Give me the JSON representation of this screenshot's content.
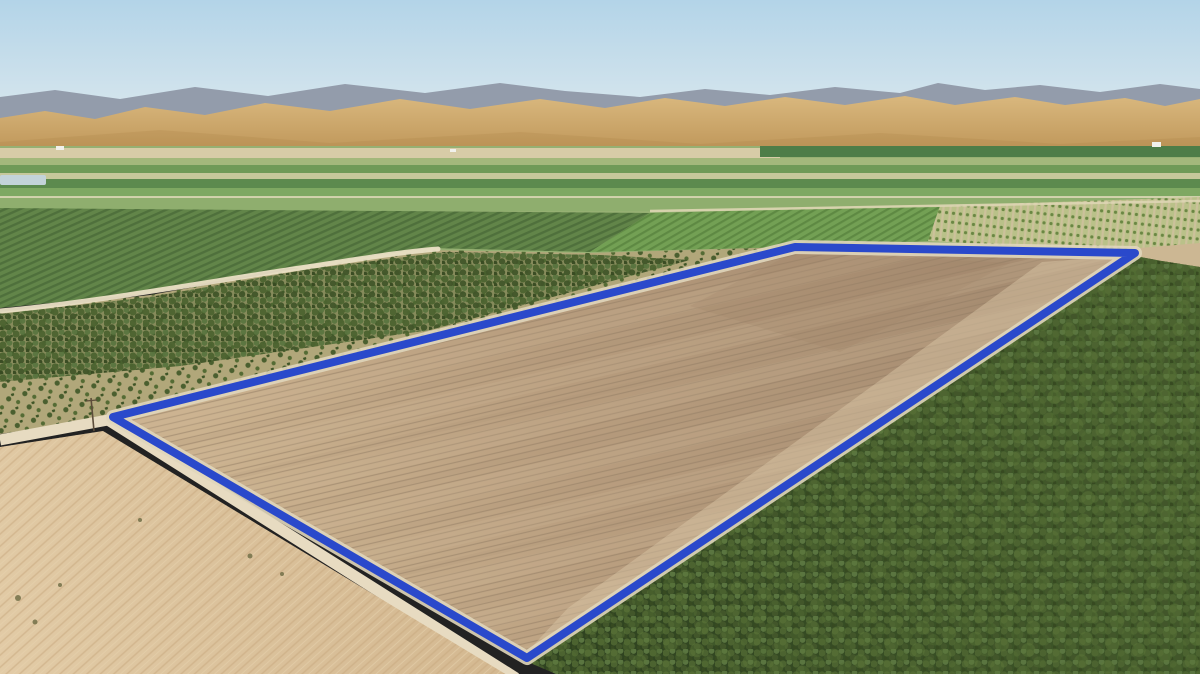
{
  "meta": {
    "title": "Aerial farmland parcel photo",
    "width": 1200,
    "height": 674,
    "description": "Drone aerial photograph of a large tilled dirt parcel outlined with a thick blue boundary, bordered by a dirt road and irrigation canal, surrounded by orchards, a vineyard block, striped green valley fields, a sandy fallow field, golden rolling hills and a hazy blue sky with a distant gray mountain ridge"
  },
  "palette": {
    "boundary_blue": "#2a49cb",
    "berm_light": "#e0d6bb",
    "sky_top": "#b3d4e8",
    "sky_horizon": "#e4edf1",
    "mountain_gray": "#939cab",
    "hill_gold_light": "#d9b87e",
    "hill_gold_dark": "#ba9052",
    "parcel_dirt_dark": "#a78d72",
    "parcel_dirt_light": "#cbb28f",
    "orchard_dark_green": "#35482a",
    "sand_light": "#e2cba6",
    "road_tan": "#e7dbc1",
    "canal_dark": "#5c6a4a",
    "water_gray": "#adbac1"
  },
  "scene": {
    "gradients": [
      {
        "id": "skyGrad",
        "x1": 0,
        "y1": 0,
        "x2": 0,
        "y2": 162,
        "stops": [
          [
            "0%",
            "#b3d4e8"
          ],
          [
            "55%",
            "#cfe2ec"
          ],
          [
            "100%",
            "#e4edf1"
          ]
        ]
      },
      {
        "id": "hillGrad",
        "x1": 0,
        "y1": 96,
        "x2": 0,
        "y2": 162,
        "stops": [
          [
            "0%",
            "#d9b87e"
          ],
          [
            "100%",
            "#ba9052"
          ]
        ]
      },
      {
        "id": "parcelGrad",
        "x1": 980,
        "y1": 280,
        "x2": 260,
        "y2": 580,
        "stops": [
          [
            "0%",
            "#a78d72"
          ],
          [
            "55%",
            "#b89d7e"
          ],
          [
            "100%",
            "#cbb28f"
          ]
        ]
      },
      {
        "id": "sandGrad",
        "x1": 520,
        "y1": 500,
        "x2": 0,
        "y2": 678,
        "stops": [
          [
            "0%",
            "#d2b68e"
          ],
          [
            "100%",
            "#e2cba6"
          ]
        ]
      },
      {
        "id": "orchardGrad",
        "x1": 1150,
        "y1": 300,
        "x2": 620,
        "y2": 660,
        "stops": [
          [
            "0%",
            "#46602c"
          ],
          [
            "100%",
            "#2f4320"
          ]
        ]
      }
    ],
    "patterns": [
      {
        "id": "furrows",
        "w": 6,
        "h": 6,
        "rotate": -13,
        "shapes": [
          {
            "t": "line",
            "a": {
              "x1": 0,
              "y1": 1,
              "x2": 6,
              "y2": 1,
              "stroke": "#8f7a62",
              "stroke-width": 1.2
            }
          }
        ]
      },
      {
        "id": "broadBands",
        "w": 150,
        "h": 44,
        "rotate": -13,
        "shapes": [
          {
            "t": "rect",
            "a": {
              "x": 0,
              "y": 0,
              "width": 150,
              "height": 18,
              "fill": "#ceb897",
              "opacity": 0.6
            }
          },
          {
            "t": "rect",
            "a": {
              "x": 0,
              "y": 30,
              "width": 150,
              "height": 6,
              "fill": "#a28a6e",
              "opacity": 0.4
            }
          }
        ]
      },
      {
        "id": "treeSparse",
        "w": 17,
        "h": 14,
        "rotate": -18,
        "shapes": [
          {
            "t": "circle",
            "a": {
              "cx": 4,
              "cy": 4,
              "r": 2.6,
              "fill": "#4a5f2f"
            }
          },
          {
            "t": "circle",
            "a": {
              "cx": 12,
              "cy": 10,
              "r": 2.1,
              "fill": "#546b34"
            }
          },
          {
            "t": "circle",
            "a": {
              "cx": 9,
              "cy": 1,
              "r": 1.6,
              "fill": "#3f5527"
            }
          }
        ]
      },
      {
        "id": "treeDense",
        "w": 13,
        "h": 11,
        "rotate": 0,
        "shapes": [
          {
            "t": "circle",
            "a": {
              "cx": 3,
              "cy": 4,
              "r": 3.6,
              "fill": "#4c6330"
            }
          },
          {
            "t": "circle",
            "a": {
              "cx": 9.5,
              "cy": 2,
              "r": 2.9,
              "fill": "#5a7540"
            }
          },
          {
            "t": "circle",
            "a": {
              "cx": 8,
              "cy": 8.5,
              "r": 3.2,
              "fill": "#42562a"
            }
          },
          {
            "t": "circle",
            "a": {
              "cx": 1,
              "cy": 10,
              "r": 2.4,
              "fill": "#374a21"
            }
          }
        ]
      },
      {
        "id": "treeBig",
        "w": 27,
        "h": 23,
        "rotate": 12,
        "shapes": [
          {
            "t": "circle",
            "a": {
              "cx": 7,
              "cy": 8,
              "r": 7,
              "fill": "#5d7839"
            }
          },
          {
            "t": "circle",
            "a": {
              "cx": 20,
              "cy": 18,
              "r": 6,
              "fill": "#526c33"
            }
          }
        ]
      },
      {
        "id": "vineRows",
        "w": 6,
        "h": 6,
        "rotate": -24,
        "bg": "#628549",
        "shapes": [
          {
            "t": "rect",
            "a": {
              "x": 0,
              "y": 0,
              "width": 6,
              "height": 2.4,
              "fill": "#4f703c"
            }
          }
        ]
      },
      {
        "id": "brightRows",
        "w": 6,
        "h": 6,
        "rotate": -30,
        "bg": "#73a054",
        "shapes": [
          {
            "t": "rect",
            "a": {
              "x": 0,
              "y": 0,
              "width": 6,
              "height": 2.2,
              "fill": "#5e8943"
            }
          }
        ]
      },
      {
        "id": "youngRows",
        "w": 7,
        "h": 9,
        "rotate": 6,
        "bg": "#bac189",
        "shapes": [
          {
            "t": "rect",
            "a": {
              "x": 0,
              "y": 0,
              "width": 2.2,
              "height": 9,
              "fill": "#ccc19b"
            }
          },
          {
            "t": "circle",
            "a": {
              "cx": 4.6,
              "cy": 4.5,
              "r": 1.6,
              "fill": "#6a8743"
            }
          }
        ]
      },
      {
        "id": "sandStreaks",
        "w": 9,
        "h": 9,
        "rotate": -42,
        "shapes": [
          {
            "t": "line",
            "a": {
              "x1": 0,
              "y1": 1,
              "x2": 9,
              "y2": 1,
              "stroke": "#c8a97f",
              "stroke-width": 1.5
            }
          },
          {
            "t": "line",
            "a": {
              "x1": 0,
              "y1": 5.5,
              "x2": 9,
              "y2": 5.5,
              "stroke": "#e6d2ae",
              "stroke-width": 1
            }
          }
        ]
      }
    ],
    "layers": [
      {
        "name": "sky",
        "type": "rect",
        "attrs": {
          "x": 0,
          "y": 0,
          "width": 1200,
          "height": 163,
          "fill": "url(#skyGrad)"
        }
      },
      {
        "name": "mountain-ridge",
        "type": "polygon",
        "attrs": {
          "points": "0,97 55,90 120,99 195,87 268,96 345,84 425,93 500,83 565,91 640,97 705,89 770,95 835,87 900,93 938,83 985,90 1040,85 1100,92 1160,84 1200,89 1200,132 0,132",
          "fill": "#939cab"
        }
      },
      {
        "name": "golden-hills",
        "type": "polygon",
        "attrs": {
          "points": "0,118 45,111 95,119 145,107 205,115 265,103 330,111 400,99 470,109 540,99 605,108 665,98 725,106 785,97 845,105 905,96 955,105 1015,97 1065,105 1125,98 1165,106 1200,99 1200,160 0,160",
          "fill": "url(#hillGrad)"
        }
      },
      {
        "name": "hill-shadow",
        "type": "polygon",
        "attrs": {
          "points": "0,142 160,130 330,143 520,132 700,144 880,133 1060,144 1200,137 1200,160 0,160",
          "fill": "#a87e46",
          "opacity": 0.22
        }
      },
      {
        "name": "valley-base",
        "type": "rect",
        "attrs": {
          "x": 0,
          "y": 146,
          "width": 1200,
          "height": 122,
          "fill": "#96b073"
        }
      },
      {
        "name": "field-strip-pale",
        "type": "rect",
        "attrs": {
          "x": 0,
          "y": 148,
          "width": 780,
          "height": 10,
          "fill": "#d7cca7"
        }
      },
      {
        "name": "field-strip-teal",
        "type": "rect",
        "attrs": {
          "x": 760,
          "y": 146,
          "width": 440,
          "height": 11,
          "fill": "#4e7d48"
        }
      },
      {
        "name": "field-strip-2",
        "type": "rect",
        "attrs": {
          "x": 0,
          "y": 158,
          "width": 1200,
          "height": 7,
          "fill": "#a3b87b"
        }
      },
      {
        "name": "field-strip-3",
        "type": "rect",
        "attrs": {
          "x": 0,
          "y": 165,
          "width": 1200,
          "height": 8,
          "fill": "#6f9a57"
        }
      },
      {
        "name": "field-strip-4",
        "type": "rect",
        "attrs": {
          "x": 0,
          "y": 173,
          "width": 1200,
          "height": 6,
          "fill": "#c6c89b"
        }
      },
      {
        "name": "field-strip-5",
        "type": "rect",
        "attrs": {
          "x": 0,
          "y": 179,
          "width": 1200,
          "height": 9,
          "fill": "#5c8a4e"
        }
      },
      {
        "name": "field-strip-6",
        "type": "rect",
        "attrs": {
          "x": 0,
          "y": 188,
          "width": 1200,
          "height": 9,
          "fill": "#7ea862"
        }
      },
      {
        "name": "field-strip-7",
        "type": "rect",
        "attrs": {
          "x": 0,
          "y": 197,
          "width": 1200,
          "height": 14,
          "fill": "#8fae6e"
        }
      },
      {
        "name": "valley-road",
        "type": "rect",
        "attrs": {
          "x": 0,
          "y": 196,
          "width": 1200,
          "height": 2,
          "fill": "#e3dbbd",
          "opacity": 0.8
        }
      },
      {
        "name": "pond",
        "type": "rect",
        "attrs": {
          "x": 0,
          "y": 175,
          "width": 46,
          "height": 10,
          "rx": 2,
          "fill": "#c3d3d9"
        }
      },
      {
        "name": "farm-building-1",
        "type": "rect",
        "attrs": {
          "x": 56,
          "y": 146,
          "width": 8,
          "height": 4,
          "fill": "#f1f1ec"
        }
      },
      {
        "name": "farm-building-2",
        "type": "rect",
        "attrs": {
          "x": 450,
          "y": 149,
          "width": 6,
          "height": 3,
          "fill": "#f1f1ec"
        }
      },
      {
        "name": "farm-building-3",
        "type": "rect",
        "attrs": {
          "x": 1152,
          "y": 142,
          "width": 9,
          "height": 5,
          "fill": "#f1f1ec"
        }
      },
      {
        "name": "vineyard-block",
        "type": "polygon",
        "attrs": {
          "points": "0,208 650,213 590,252 430,248 300,266 150,293 0,308",
          "fill": "url(#vineRows)"
        }
      },
      {
        "name": "bright-field-band",
        "type": "polygon",
        "attrs": {
          "points": "590,252 650,213 940,206 928,241 795,247",
          "fill": "url(#brightRows)"
        }
      },
      {
        "name": "young-orchard",
        "type": "polygon",
        "attrs": {
          "points": "940,206 1200,197 1200,248 1135,252 928,241",
          "fill": "url(#youngRows)"
        }
      },
      {
        "name": "orchard-top-road",
        "type": "line",
        "attrs": {
          "x1": 650,
          "y1": 211,
          "x2": 1200,
          "y2": 201,
          "stroke": "#ded6b4",
          "stroke-width": 2.5,
          "opacity": 0.9
        }
      },
      {
        "name": "dirt-wedge-east",
        "type": "polygon",
        "attrs": {
          "points": "1128,249 1200,243 1200,272 1138,259",
          "fill": "#ccb793"
        }
      },
      {
        "name": "sparse-orchard-ground",
        "type": "polygon",
        "attrs": {
          "points": "0,312 150,295 300,268 430,250 590,253 795,247 113,417 0,434",
          "fill": "#b1a77a"
        }
      },
      {
        "name": "sparse-orchard-trees",
        "type": "polygon",
        "attrs": {
          "points": "0,312 150,295 300,268 430,250 590,253 795,247 113,417 0,434",
          "fill": "url(#treeSparse)"
        }
      },
      {
        "name": "dense-orchard-underlay",
        "type": "polygon",
        "attrs": {
          "points": "0,314 150,297 310,269 445,252 600,255 690,260 430,330 180,366 0,382",
          "fill": "#47612d",
          "opacity": 0.4
        }
      },
      {
        "name": "dense-orchard-trees",
        "type": "polygon",
        "attrs": {
          "points": "0,314 150,297 310,269 445,252 600,255 690,260 430,330 180,366 0,382",
          "fill": "url(#treeDense)",
          "opacity": 0.95
        }
      },
      {
        "name": "winding-road",
        "type": "path",
        "attrs": {
          "d": "M 0,311 C 90,303 200,283 300,268 C 360,259 400,252 438,249",
          "fill": "none",
          "stroke": "#eadfc5",
          "stroke-width": 5,
          "opacity": 0.95,
          "stroke-linecap": "round"
        }
      },
      {
        "name": "canal",
        "type": "line",
        "attrs": {
          "x1": 120,
          "y1": 425,
          "x2": 345,
          "y2": 516,
          "stroke": "#5c6a4a",
          "stroke-width": 8,
          "stroke-linecap": "round"
        }
      },
      {
        "name": "canal-water",
        "type": "line",
        "attrs": {
          "x1": 150,
          "y1": 449,
          "x2": 330,
          "y2": 510,
          "stroke": "#adbac1",
          "stroke-width": 2.5,
          "stroke-dasharray": "16 9",
          "opacity": 0.9
        }
      },
      {
        "name": "perimeter-road",
        "type": "path",
        "attrs": {
          "d": "M 0,440 L 108,420 L 516,678",
          "fill": "none",
          "stroke": "#e7dbc1",
          "stroke-width": 11,
          "stroke-linejoin": "round"
        }
      },
      {
        "name": "sandy-field",
        "type": "polygon",
        "attrs": {
          "points": "0,447 103,431 512,678 0,678",
          "fill": "url(#sandGrad)"
        }
      },
      {
        "name": "sandy-field-streaks",
        "type": "polygon",
        "attrs": {
          "points": "0,447 103,431 512,678 0,678",
          "fill": "url(#sandStreaks)",
          "opacity": 0.55
        }
      },
      {
        "name": "scrub-1",
        "type": "circle",
        "attrs": {
          "cx": 18,
          "cy": 598,
          "r": 3,
          "fill": "#6b6a42",
          "opacity": 0.8
        }
      },
      {
        "name": "scrub-2",
        "type": "circle",
        "attrs": {
          "cx": 35,
          "cy": 622,
          "r": 2.5,
          "fill": "#6b6a42",
          "opacity": 0.8
        }
      },
      {
        "name": "scrub-3",
        "type": "circle",
        "attrs": {
          "cx": 60,
          "cy": 585,
          "r": 2,
          "fill": "#6b6a42",
          "opacity": 0.8
        }
      },
      {
        "name": "scrub-4",
        "type": "circle",
        "attrs": {
          "cx": 250,
          "cy": 556,
          "r": 2.5,
          "fill": "#6b6a42",
          "opacity": 0.8
        }
      },
      {
        "name": "scrub-5",
        "type": "circle",
        "attrs": {
          "cx": 282,
          "cy": 574,
          "r": 2,
          "fill": "#6b6a42",
          "opacity": 0.8
        }
      },
      {
        "name": "scrub-6",
        "type": "circle",
        "attrs": {
          "cx": 140,
          "cy": 520,
          "r": 2,
          "fill": "#6b6a42",
          "opacity": 0.8
        }
      },
      {
        "name": "tilled-parcel",
        "type": "polygon",
        "attrs": {
          "points": "113,417 795,247 1135,253 527,658",
          "fill": "url(#parcelGrad)"
        }
      },
      {
        "name": "parcel-furrows",
        "type": "polygon",
        "attrs": {
          "points": "113,417 795,247 1135,253 527,658",
          "fill": "url(#furrows)",
          "opacity": 0.5
        }
      },
      {
        "name": "parcel-soil-bands",
        "type": "polygon",
        "attrs": {
          "points": "113,417 795,247 1135,253 527,658",
          "fill": "url(#broadBands)",
          "opacity": 0.35
        }
      },
      {
        "name": "parcel-light-swath",
        "type": "polygon",
        "attrs": {
          "points": "1135,255 1042,262 568,608 527,652",
          "fill": "#d8c4a4",
          "opacity": 0.5
        }
      },
      {
        "name": "parcel-dark-patch",
        "type": "polygon",
        "attrs": {
          "points": "795,252 1010,263 840,352 690,306",
          "fill": "#9e8368",
          "opacity": 0.25
        }
      },
      {
        "name": "orchard-southeast",
        "type": "polygon",
        "attrs": {
          "points": "528,662 1135,256 1162,261 1200,267 1200,674 556,674",
          "fill": "url(#orchardGrad)"
        }
      },
      {
        "name": "orchard-southeast-trees",
        "type": "polygon",
        "attrs": {
          "points": "528,662 1135,256 1162,261 1200,267 1200,674 556,674",
          "fill": "url(#treeDense)"
        }
      },
      {
        "name": "orchard-southeast-clumps",
        "type": "polygon",
        "attrs": {
          "points": "528,662 1135,256 1162,261 1200,267 1200,674 556,674",
          "fill": "url(#treeBig)",
          "opacity": 0.45
        }
      },
      {
        "name": "boundary-berm",
        "type": "polygon",
        "attrs": {
          "points": "113,417 795,247 1135,253 527,658",
          "fill": "none",
          "stroke": "#e0d6bb",
          "stroke-width": 14,
          "stroke-linejoin": "round",
          "opacity": 0.9
        }
      },
      {
        "name": "parcel-boundary",
        "type": "polygon",
        "attrs": {
          "points": "113,417 795,247 1135,253 527,658",
          "fill": "none",
          "stroke": "#2a49cb",
          "stroke-width": 8,
          "stroke-linejoin": "round"
        }
      },
      {
        "name": "utility-pole",
        "type": "line",
        "attrs": {
          "x1": 91,
          "y1": 398,
          "x2": 94,
          "y2": 431,
          "stroke": "#5d4d3a",
          "stroke-width": 1.6
        }
      },
      {
        "name": "utility-pole-crossarm",
        "type": "line",
        "attrs": {
          "x1": 86,
          "y1": 401,
          "x2": 97,
          "y2": 400,
          "stroke": "#5d4d3a",
          "stroke-width": 1.2
        }
      }
    ]
  }
}
